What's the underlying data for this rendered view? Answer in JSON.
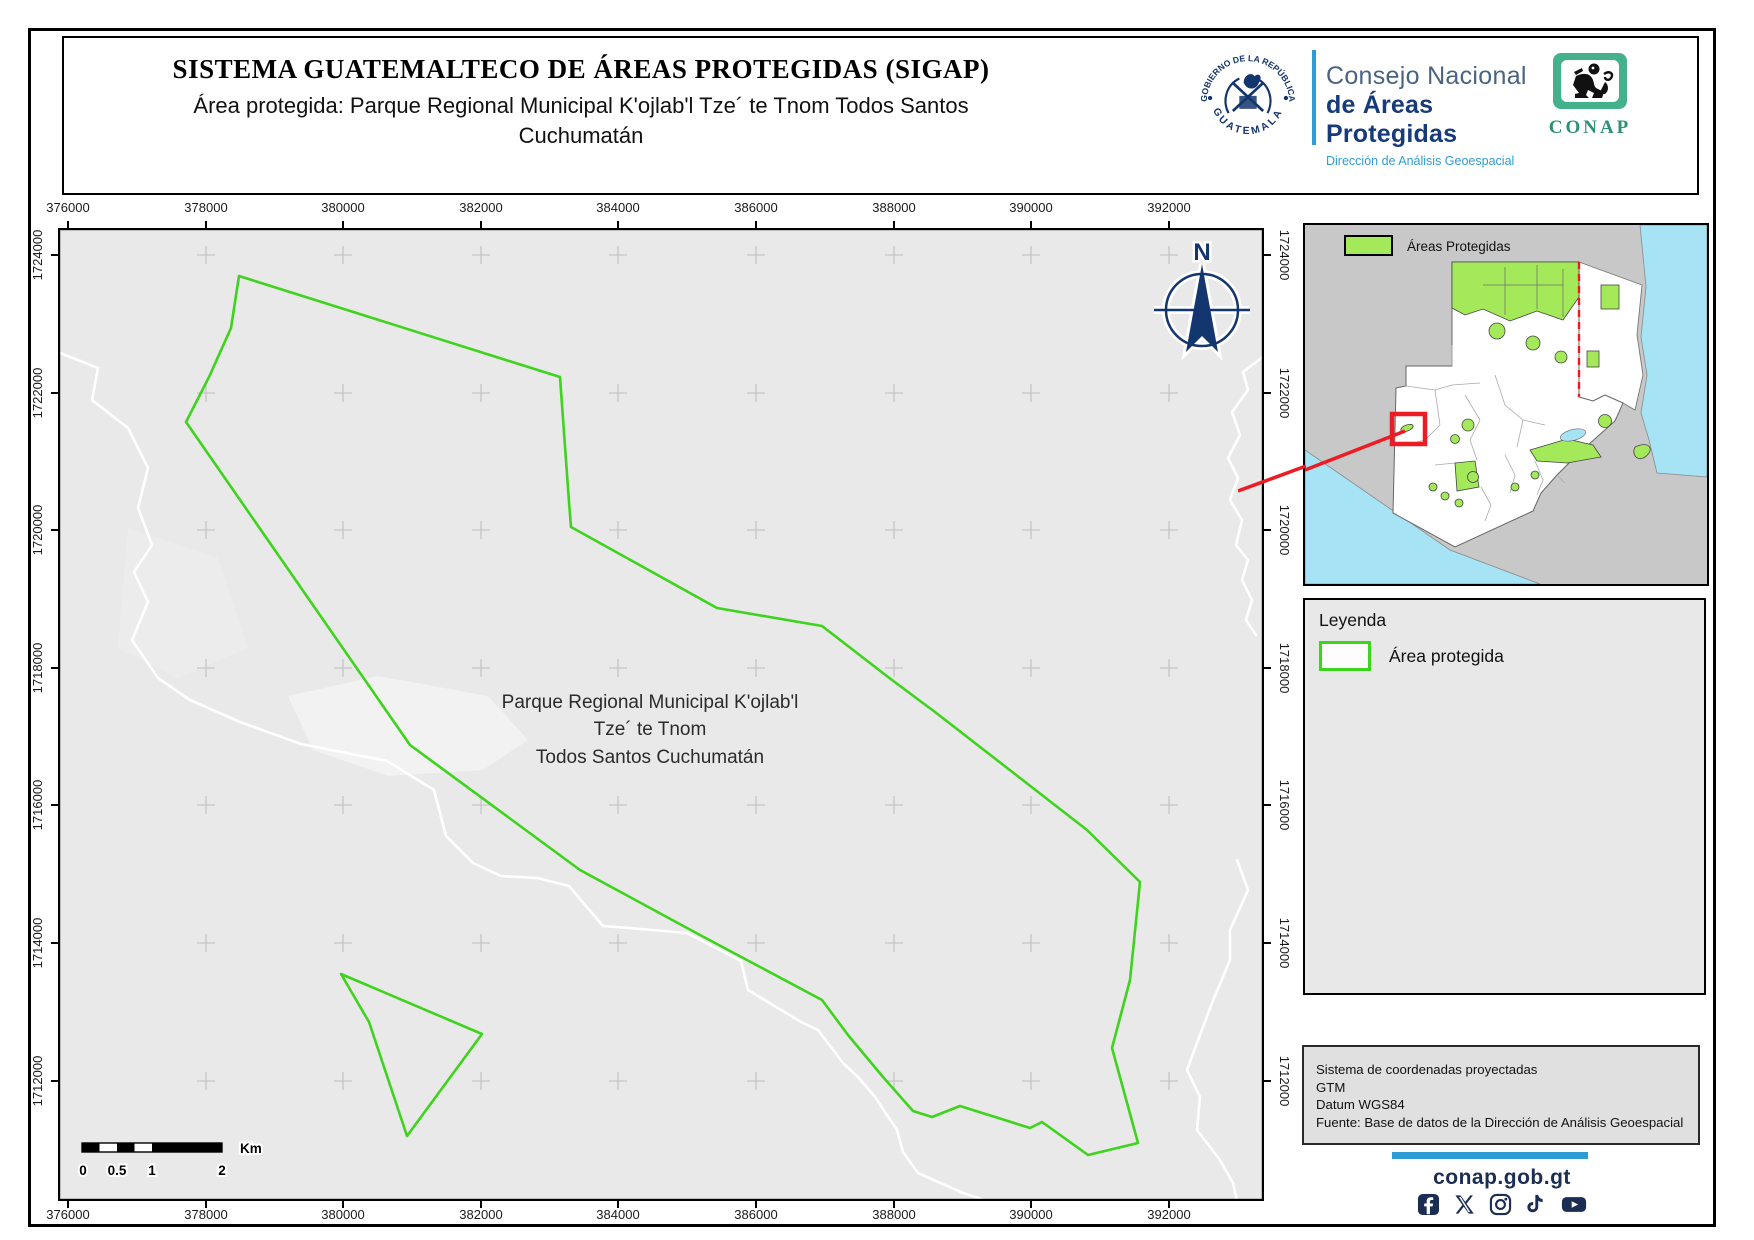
{
  "header": {
    "title": "SISTEMA GUATEMALTECO DE ÁREAS PROTEGIDAS  (SIGAP)",
    "subtitle": "Área protegida: Parque Regional Municipal K'ojlab'l Tze´ te Tnom Todos Santos Cuchumatán"
  },
  "branding": {
    "seal_top": "GOBIERNO DE LA REPÚBLICA",
    "seal_bottom": "GUATEMALA",
    "org_line1": "Consejo Nacional",
    "org_line2": "de Áreas Protegidas",
    "org_line3": "Dirección de Análisis Geoespacial",
    "conap": "CONAP"
  },
  "map": {
    "label_line1": "Parque Regional Municipal K'ojlab'l",
    "label_line2": "Tze´ te Tnom",
    "label_line3": "Todos Santos Cuchumatán",
    "north": "N",
    "axes": {
      "x_ticks": [
        "376000",
        "378000",
        "380000",
        "382000",
        "384000",
        "386000",
        "388000",
        "390000",
        "392000"
      ],
      "y_ticks": [
        "1724000",
        "1722000",
        "1720000",
        "1718000",
        "1716000",
        "1714000",
        "1712000"
      ]
    },
    "scalebar": {
      "labels": [
        "0",
        "0.5",
        "1",
        "2"
      ],
      "unit": "Km"
    }
  },
  "inset": {
    "legend_label": "Áreas Protegidas"
  },
  "legend": {
    "title": "Leyenda",
    "item": "Área protegida"
  },
  "info": {
    "line1": "Sistema de coordenadas proyectadas",
    "line2": "GTM",
    "line3": "Datum WGS84",
    "line4": "Fuente: Base de datos de la Dirección de Análisis Geoespacial"
  },
  "footer": {
    "website": "conap.gob.gt",
    "icons": [
      "facebook",
      "x",
      "instagram",
      "tiktok",
      "youtube"
    ]
  },
  "colors": {
    "boundary_green": "#3ed31c",
    "protected_fill": "#a3e959",
    "sea_blue": "#a6e3f5",
    "highlight_red": "#ed1c24",
    "navy": "#14366e",
    "accent_blue": "#2f9cd4",
    "footer_navy": "#1b2d52",
    "conap_green": "#2e9077"
  }
}
